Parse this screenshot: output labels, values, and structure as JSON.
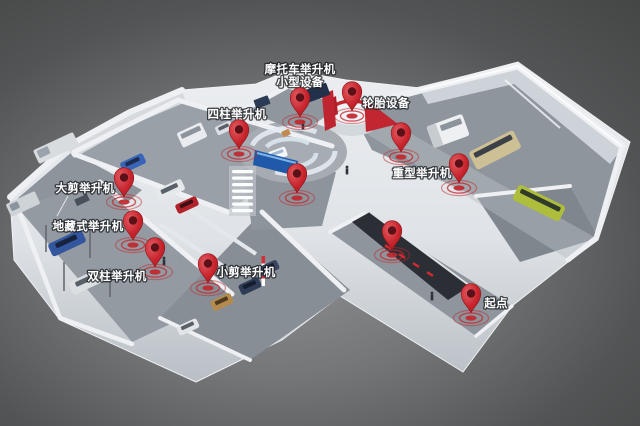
{
  "scene": {
    "type": "3d-isometric-facility-map",
    "background_color": "#474747",
    "wall_color": "#e6e9ec",
    "floor_color": "#949aa2",
    "pin_color": "#c1272d",
    "label_color": "#ffffff"
  },
  "map": {
    "labels": [
      {
        "id": "motorcycle-lift-small-equipment",
        "lines": [
          "摩托车举升机",
          "小型设备"
        ],
        "x": 300,
        "y": 73
      },
      {
        "id": "four-post-lift",
        "lines": [
          "四柱举升机"
        ],
        "x": 237,
        "y": 118
      },
      {
        "id": "tire-equipment",
        "lines": [
          "轮胎设备"
        ],
        "x": 386,
        "y": 107
      },
      {
        "id": "large-scissor-lift",
        "lines": [
          "大剪举升机"
        ],
        "x": 85,
        "y": 192
      },
      {
        "id": "underground-lift",
        "lines": [
          "地藏式举升机"
        ],
        "x": 88,
        "y": 230
      },
      {
        "id": "two-post-lift",
        "lines": [
          "双柱举升机"
        ],
        "x": 117,
        "y": 280
      },
      {
        "id": "small-scissor-lift",
        "lines": [
          "小剪举升机"
        ],
        "x": 246,
        "y": 276
      },
      {
        "id": "heavy-duty-lift",
        "lines": [
          "重型举升机"
        ],
        "x": 422,
        "y": 177
      },
      {
        "id": "start-point",
        "lines": [
          "起点"
        ],
        "x": 496,
        "y": 307
      }
    ],
    "pins": [
      {
        "id": "pin-four-post-lift",
        "x": 239,
        "y": 149
      },
      {
        "id": "pin-motorcycle-lift",
        "x": 300,
        "y": 117
      },
      {
        "id": "pin-tire-equipment",
        "x": 352,
        "y": 111
      },
      {
        "id": "pin-center-display",
        "x": 297,
        "y": 193
      },
      {
        "id": "pin-large-scissor-lift",
        "x": 124,
        "y": 197
      },
      {
        "id": "pin-underground-lift",
        "x": 133,
        "y": 240
      },
      {
        "id": "pin-two-post-lift",
        "x": 155,
        "y": 267
      },
      {
        "id": "pin-small-scissor-lift",
        "x": 208,
        "y": 283
      },
      {
        "id": "pin-heavy-duty-lift-1",
        "x": 401,
        "y": 152
      },
      {
        "id": "pin-heavy-duty-lift-2",
        "x": 459,
        "y": 183
      },
      {
        "id": "pin-corridor",
        "x": 392,
        "y": 250
      },
      {
        "id": "pin-start-point",
        "x": 471,
        "y": 313
      }
    ]
  }
}
